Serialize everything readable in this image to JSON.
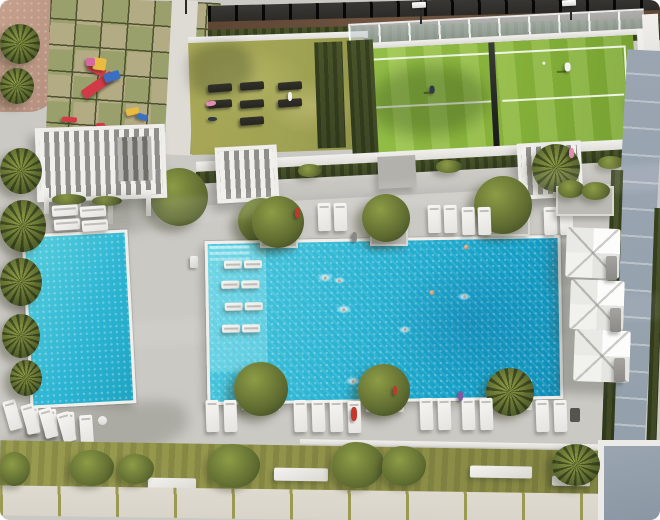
{
  "image": {
    "type": "architectural-aerial-render",
    "subject": "residential amenity terrace seen from above: large main swimming pool with in-water loungers and swimmers, kids pool, three white parasols, rows of sun loungers, landscaped planters, padel tennis court, lawn gym and children's playground"
  },
  "colors": {
    "deck": "#cbc9c4",
    "deck-light": "#dedbd5",
    "pool-1": "#4ecadf",
    "pool-2": "#2cb4d3",
    "pool-3": "#149ec6",
    "pool-4": "#0f8db7",
    "lawn": "#a0a253",
    "lawn-light": "#b5b465",
    "turf": "#8fba3e",
    "turf-light": "#9fca4e",
    "turf-dark": "#7da835",
    "hedge": "#49542a",
    "tree": "#5f6c31",
    "tree-light": "#8d9c46",
    "tree-dark": "#3c4722",
    "sand": "#c5a08d",
    "tile-a": "#b3ab84",
    "tile-b": "#9aa06b",
    "grout": "#4e5230",
    "dirt": "#6f5440",
    "path-blue": "#93a0ac",
    "path-blue-joint": "#b9c1c9",
    "paver": "#d8d4ca",
    "paver-joint": "#9b9a52",
    "strip-green": "#8e9048",
    "umbrella-a": "#fcfcfa",
    "umbrella-b": "#e4e4e0",
    "lounger": "#f7f6f3",
    "gym-mat": "#26251f",
    "play-red": "#d23a46",
    "play-yellow": "#e9bb3e",
    "play-blue": "#3a6fc4",
    "play-pink": "#d66a9e",
    "person-red": "#c0392b",
    "person-pink": "#e38bb2",
    "person-purple": "#7e5a9e",
    "person-white": "#f2f2ee",
    "person-gray": "#8a8884",
    "person-dark": "#2f3a44",
    "person-skin": "#caa188"
  },
  "objects": {
    "main_pool": {
      "swimmers": 8,
      "in_water_loungers": 8,
      "edge_planter_trees": 6
    },
    "kids_pool": {
      "loungers_below": 4
    },
    "parasols": 3,
    "padel_court": {
      "players": 2,
      "floodlights": 2
    },
    "outdoor_gym_mats": 7,
    "playground_pieces": 9,
    "deck_lounger_count_bottom_row": 16,
    "pergolas": 3
  }
}
